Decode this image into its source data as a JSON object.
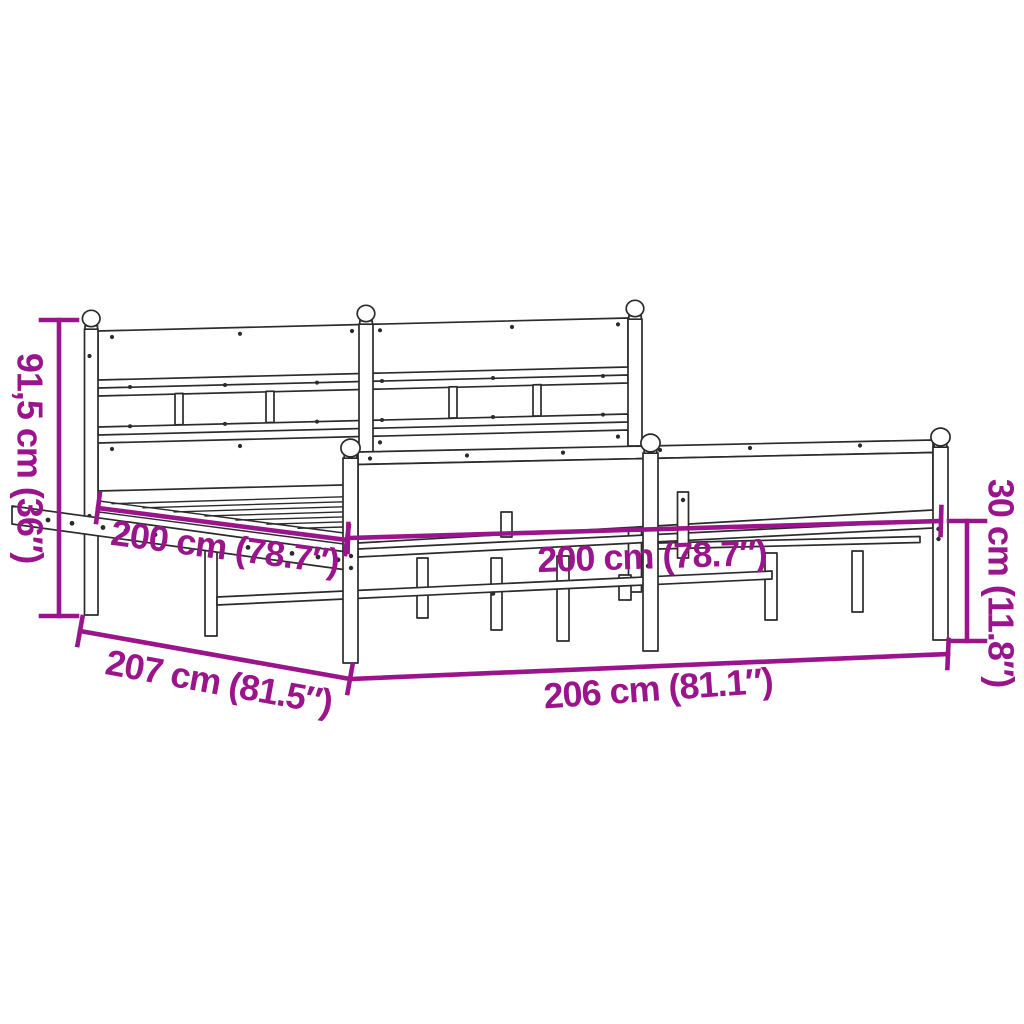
{
  "colors": {
    "dimension_accent": "#9A148C",
    "line_color": "#2b2b2b",
    "background": "#ffffff"
  },
  "diagram": {
    "subject": "metal bed frame with headboard and footboard",
    "dimensions": {
      "headboard_height": {
        "label": "91,5 cm (36″)"
      },
      "inner_length": {
        "label": "200 cm (78.7″)"
      },
      "inner_width": {
        "label": "200 cm (78.7″)"
      },
      "outer_length": {
        "label": "207 cm (81.5″)"
      },
      "outer_width": {
        "label": "206 cm (81.1″)"
      },
      "footboard_height": {
        "label": "30 cm (11.8″)"
      }
    }
  }
}
